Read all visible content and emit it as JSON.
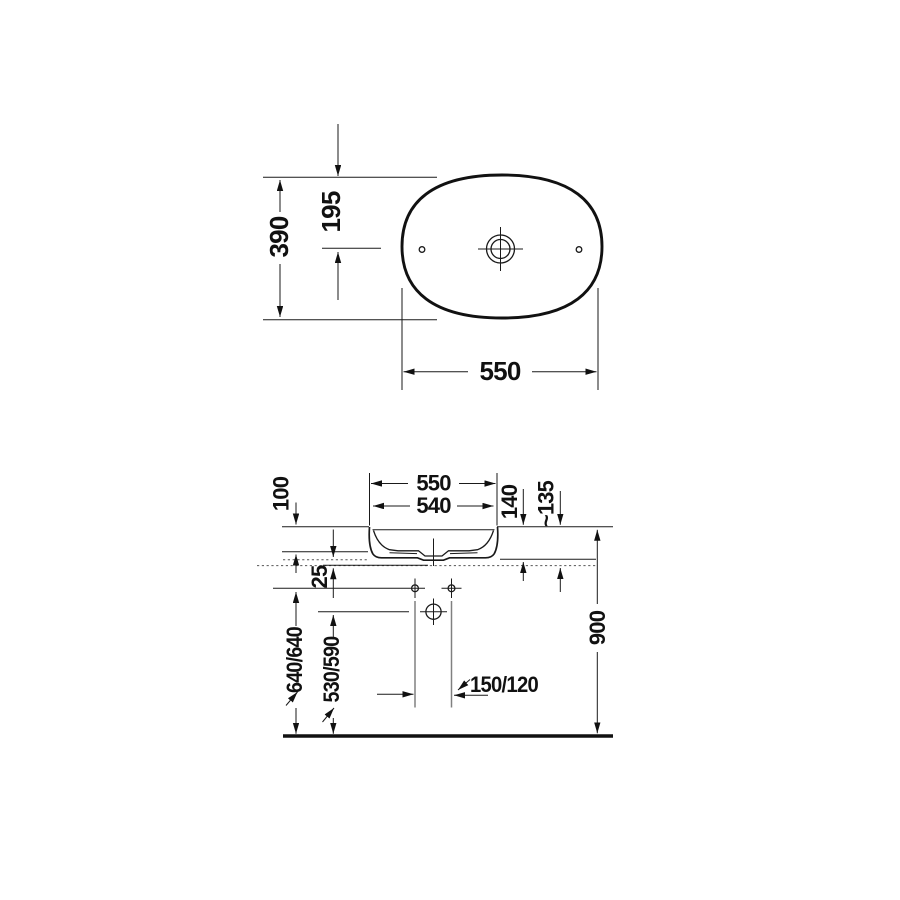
{
  "drawing": {
    "type": "washbasin-technical-drawing",
    "views": [
      "top-view",
      "front-elevation"
    ]
  },
  "colors": {
    "line": "#1a1a1a",
    "secondary_line": "#808080",
    "background": "#ffffff"
  },
  "top_view": {
    "width": "550",
    "height": "390",
    "center_offset": "195"
  },
  "elevation_view": {
    "outer_width": "550",
    "inner_width": "540",
    "rim_above_counter": "100",
    "basin_height": "140",
    "basin_height_alt": "~135",
    "counter_offset": "25",
    "rim_floor_height": "900",
    "holes_floor_height": "640/640",
    "drain_floor_height": "530/590",
    "drain_offset": "150/120"
  }
}
